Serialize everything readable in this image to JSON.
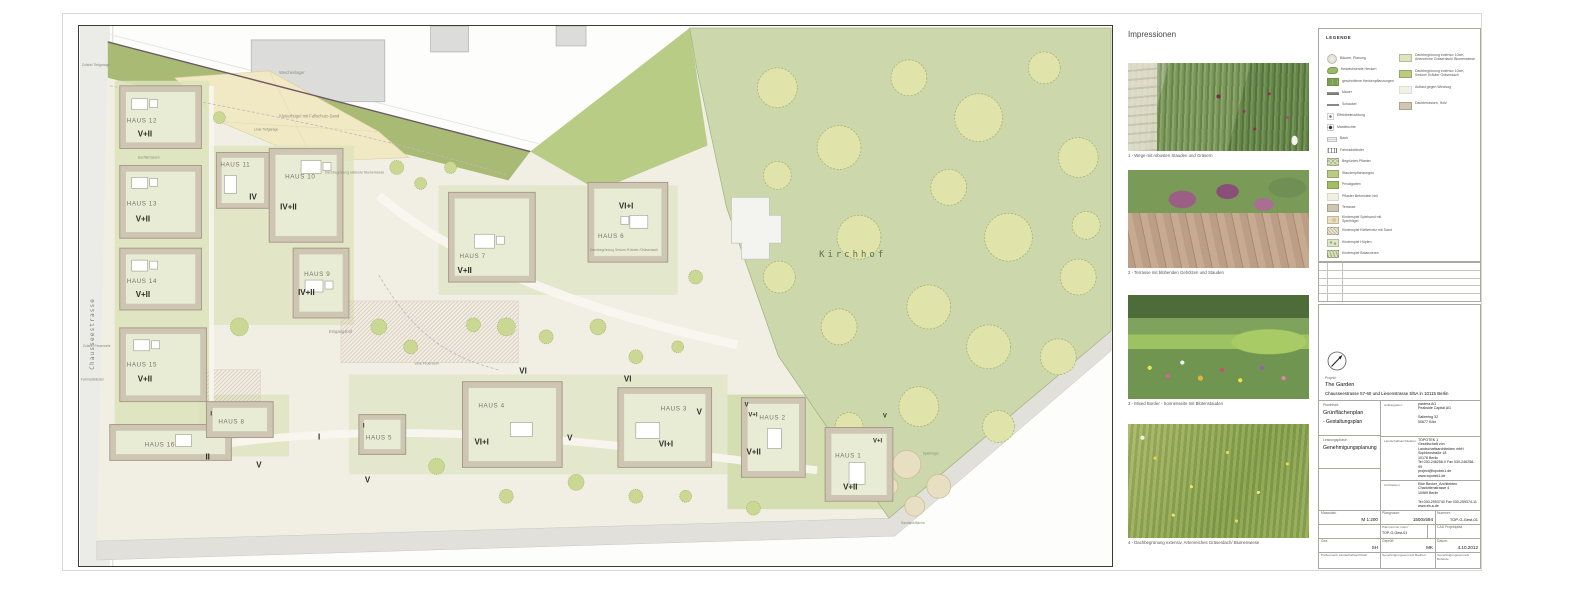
{
  "plan": {
    "street_left": "Chausseestrasse",
    "buildings": [
      {
        "name": "HAUS 12",
        "floors": "V+II"
      },
      {
        "name": "HAUS 13",
        "floors": "V+II"
      },
      {
        "name": "HAUS 14",
        "floors": "V+II"
      },
      {
        "name": "HAUS 15",
        "floors": "V+II"
      },
      {
        "name": "HAUS 16",
        "floors": ""
      },
      {
        "name": "HAUS 11",
        "floors": "IV"
      },
      {
        "name": "HAUS 10",
        "floors": "IV+II"
      },
      {
        "name": "HAUS 9",
        "floors": "IV+II"
      },
      {
        "name": "HAUS 8",
        "floors": "I"
      },
      {
        "name": "HAUS 7",
        "floors": "V+II"
      },
      {
        "name": "HAUS 6",
        "floors": "VI+I"
      },
      {
        "name": "HAUS 5",
        "floors": "I"
      },
      {
        "name": "HAUS 4",
        "floors": "VI+I"
      },
      {
        "name": "HAUS 3",
        "floors": "VI+I"
      },
      {
        "name": "HAUS 2",
        "floors": "V+II"
      },
      {
        "name": "HAUS 1",
        "floors": "V+II"
      }
    ],
    "ground_labels": [
      "II",
      "V",
      "I",
      "V",
      "VI",
      "V",
      "VI",
      "V"
    ],
    "extra_labels": [
      "V",
      "V+I",
      "V",
      "V+I"
    ],
    "annotations": {
      "kirchhof": "Kirchhof",
      "weichenlager": "Weichenlager",
      "mauer_bestand": "Mauer Bestand",
      "kletterhuegel": "Kletterhügel mit Fallschutz-Sand",
      "eingangshof": "Eingangshof",
      "zufahrt_tiefgarage": "Zufahrt Tiefgarage",
      "zufahrt_feuerwehr": "Zufahrt Feuerwehr",
      "fahrradstaender": "Fahrradständer",
      "linie_tiefgarage": "Linie Tiefgarage",
      "linie_feuerwehr": "Linie Feuerwehr",
      "dachterrassen": "Dachterrassen",
      "dachbegruenung_sedum": "Dachbegrünung Sedum /Kräuter /Gräserdach",
      "dachbegruenung_blumen": "Dachbegrünung extensiv/ Blumenwiese",
      "spielhuegel": "Spielhügel",
      "sandspielflaeche": "Sandspielfläche"
    }
  },
  "impressionen": {
    "title": "Impressionen",
    "photos": [
      {
        "caption": "1 - Wege mit robusten Stauden und Gräsern"
      },
      {
        "caption": "2 - Terrasse mit blühenden Gehölzen und Stauden"
      },
      {
        "caption": "3 - Mixed Border - Sonnenseite mit Blütenstauden"
      },
      {
        "caption": "4 - Dachbegrünung extensiv, Artenreiches Gräserdach/ Blumenwiese"
      }
    ]
  },
  "legend": {
    "title": "LEGENDE",
    "items_left": [
      "Bäume, Planung",
      "freiwachsende Hecken",
      "geschnittene Heckenpflanzungen",
      "Mauer",
      "Schaukel",
      "Effektbeleuchtung",
      "Mastleuchte",
      "Bank",
      "Fahrradständer",
      "Begrüntes Pflaster",
      "Staudenpflanzungen",
      "Privatgarten",
      "Pflaster Betonstein hell",
      "Terrasse",
      "Kinderspiel Spielsand mit Spielhügel",
      "Kinderspiel Kletternetz mit Sand",
      "Kinderspiel Hüpfen",
      "Kinderspiel Balancieren"
    ],
    "items_right": [
      "Dachbegrünung extensiv 10cm, Artenreiche Gräserdach/ Blumenwiese",
      "Dachbegrünung extensiv 10cm, Sedum/ Kräuter Gräserdach",
      "Auflast gegen Windsog",
      "Dachterrassen, Holz"
    ]
  },
  "titleblock": {
    "projekt_label": "Projekt:",
    "projekt_name": "The Garden",
    "projekt_address": "Chausseestrasse 57-60 und Liesenstrasse 5/5A in 10115 Berlin",
    "planinhalt_label": "Planinhalt:",
    "planinhalt_1": "Grünflächenplan",
    "planinhalt_2": "- Gestaltungsplan",
    "leistungsphase_label": "Leistungsphase:",
    "leistungsphase": "Genehmigungsplanung",
    "auftraggeber_label": "Auftraggeber:",
    "auftraggeber": "pantera AG\nPeakside Capital AG\n\nSalierring 32\n50677 Köln",
    "landschaftsarchitekten_label": "Landschaftsarchitekten:",
    "landschaftsarchitekten": "TOPOTEK 1\nGesellschaft von Landschaftsarchitekten mbH\nSophienstraße 18\n10178 Berlin\nTel 030-246258-0  Fax 030-246258-99\nproject@topotek1.de\nwww.topotek1.de",
    "architekten_label": "Architekten:",
    "architekten": "Eike Becker_Architekten\nCharlottenstrasse 4\n10969 Berlin\n\nTel 030-2593740  Fax 030-259374-11\nwww.eb-a.de",
    "massstab_label": "Massstab:",
    "massstab": "M 1:200",
    "plangroesse_label": "Plangrosse:",
    "plangroesse": "1500x594",
    "nummer_label": "Nummer:",
    "nummer": "TOP-G-Gest-01",
    "plannummer_label": "Plannummer  intern:",
    "plannummer": "TOP-G-Gest-01",
    "cad_label": "CAD Projektpfad",
    "gez_label": "Gez:",
    "gez": "SH",
    "geprueft_label": "Geprüft:",
    "geprueft": "MK",
    "datum_label": "Datum:",
    "datum": "4.10.2012",
    "pruefvermerk_1": "Prüfvermerk  Landschaftsarchitekt",
    "pruefvermerk_2": "Genehmigungsvermerk  Bauherr",
    "pruefvermerk_3": "Genehmigungsvermerk  Behörde"
  }
}
